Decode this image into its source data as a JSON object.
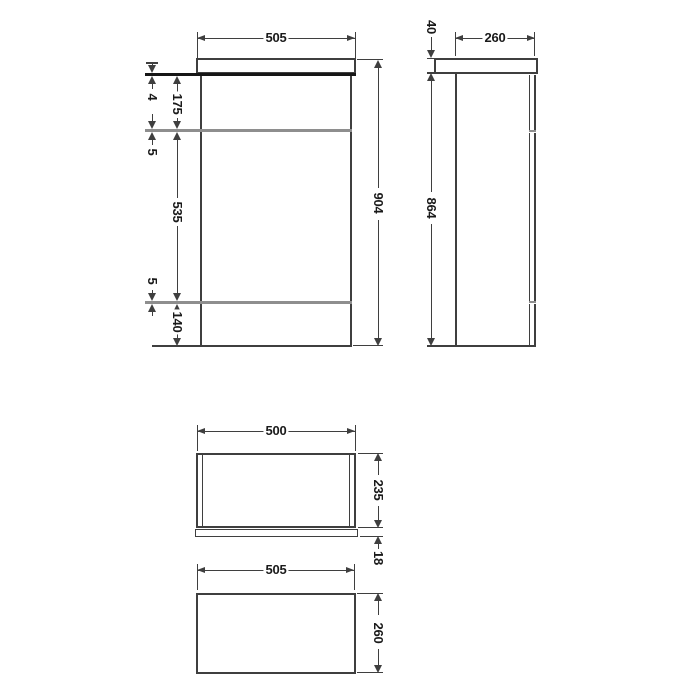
{
  "drawing_title": "WC unit technical dimension drawing",
  "colors": {
    "background": "#ffffff",
    "line": "#3f3f3f",
    "heavy_line": "#161616",
    "shelf_line": "#8e8e8e",
    "text": "#1a1a1a"
  },
  "front_view": {
    "width": "505",
    "height": "904",
    "gap": "4",
    "upper_section": "175",
    "shelf_a": "5",
    "middle_section": "535",
    "shelf_b": "5",
    "plinth": "140"
  },
  "side_view": {
    "depth": "260",
    "worktop_thickness": "40",
    "body_height": "864"
  },
  "plan_view": {
    "width": "500",
    "depth": "235",
    "plinth_depth": "18"
  },
  "base_view": {
    "width": "505",
    "depth": "260"
  }
}
